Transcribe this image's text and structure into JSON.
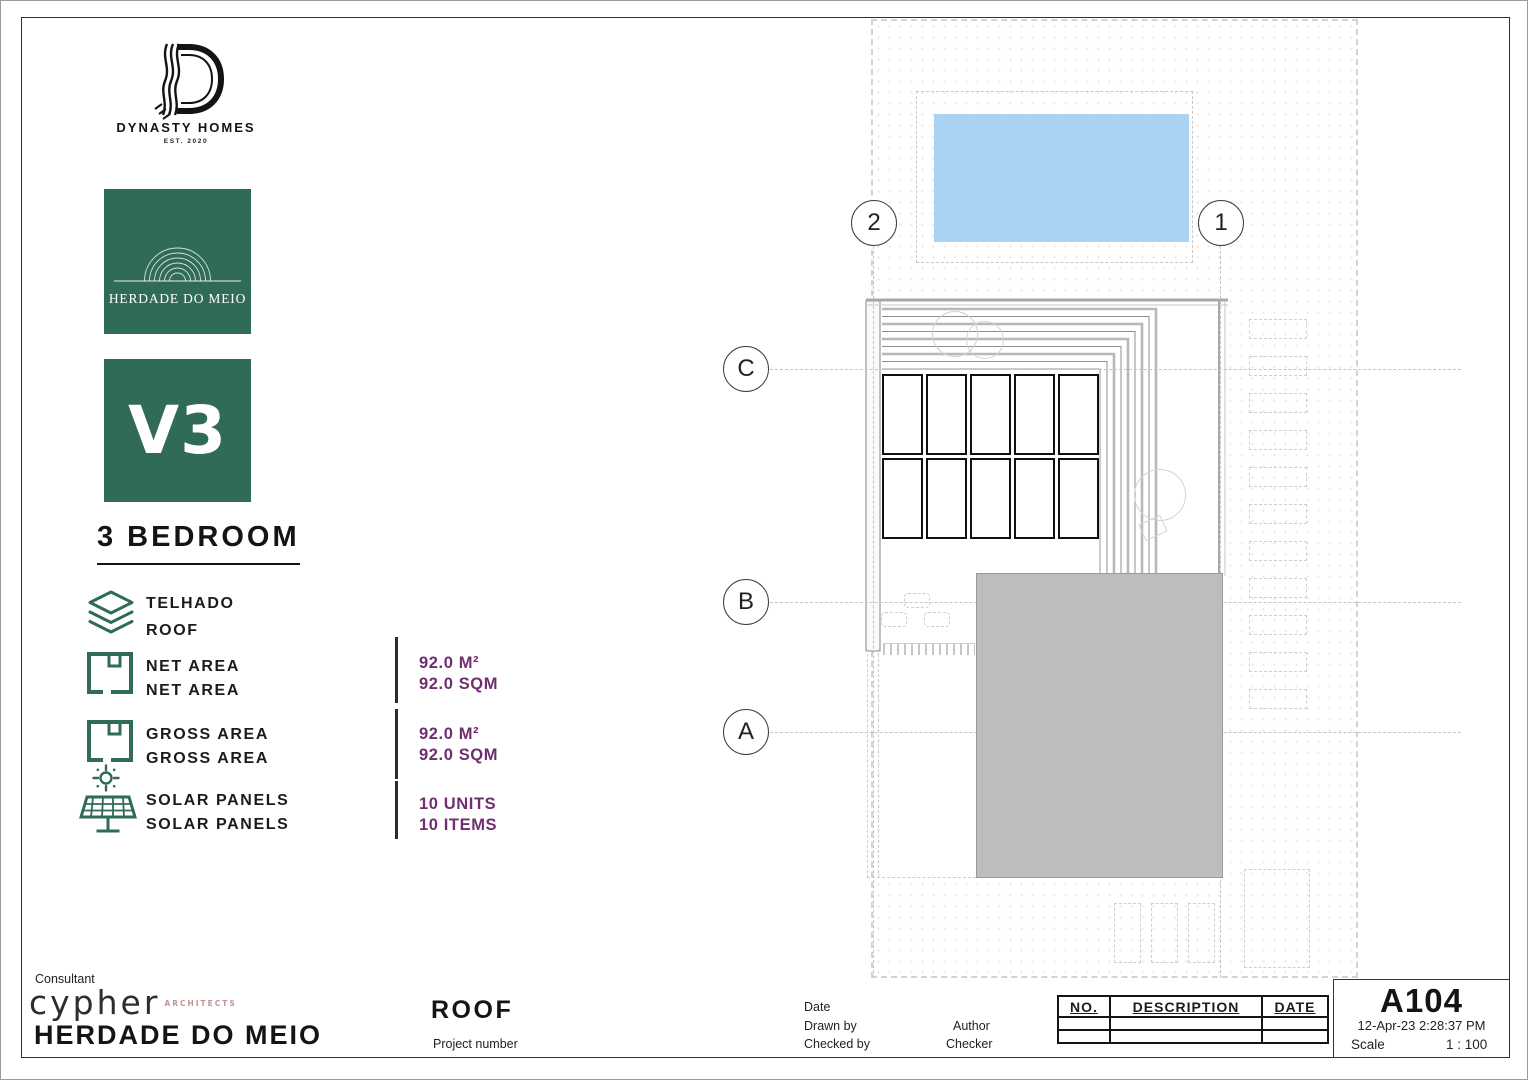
{
  "branding": {
    "company_name": "DYNASTY HOMES",
    "company_tagline": "EST. 2020",
    "estate_name": "HERDADE DO MEIO",
    "unit_code": "V3",
    "unit_type": "3 BEDROOM"
  },
  "level": {
    "name_pt": "TELHADO",
    "name_en": "ROOF"
  },
  "stats": [
    {
      "icon": "floorplan-icon",
      "label_pt": "NET AREA",
      "label_en": "NET AREA",
      "value_primary": "92.0 M²",
      "value_secondary": "92.0 SQM"
    },
    {
      "icon": "floorplan-icon",
      "label_pt": "GROSS AREA",
      "label_en": "GROSS AREA",
      "value_primary": "92.0 M²",
      "value_secondary": "92.0 SQM"
    },
    {
      "icon": "solar-panel-icon",
      "label_pt": "SOLAR PANELS",
      "label_en": "SOLAR PANELS",
      "value_primary": "10 UNITS",
      "value_secondary": "10 ITEMS"
    }
  ],
  "plan": {
    "grid_bubbles": {
      "col2": "2",
      "col1": "1",
      "rowC": "C",
      "rowB": "B",
      "rowA": "A"
    },
    "solar_panels": {
      "rows": 2,
      "cols": 5
    },
    "pergola_slats": 11
  },
  "titleblock": {
    "consultant_label": "Consultant",
    "consultant_name": "cypher",
    "consultant_subtitle": "ARCHITECTS",
    "project_name": "HERDADE DO MEIO",
    "sheet_title": "ROOF",
    "project_number_label": "Project number",
    "date_label": "Date",
    "drawn_by_label": "Drawn by",
    "drawn_by_value": "Author",
    "checked_by_label": "Checked by",
    "checked_by_value": "Checker",
    "revision_table": {
      "headers": [
        "NO.",
        "DESCRIPTION",
        "DATE"
      ],
      "rows": [
        [
          "",
          "",
          ""
        ],
        [
          "",
          "",
          ""
        ]
      ]
    },
    "sheet_number": "A104",
    "print_datetime": "12-Apr-23 2:28:37 PM",
    "scale_label": "Scale",
    "scale_value": "1 : 100"
  },
  "colors": {
    "brand_green": "#2f6b55",
    "accent_purple": "#702d70",
    "pool_blue": "#a9d2f3",
    "roof_gray": "#bdbdbd"
  }
}
